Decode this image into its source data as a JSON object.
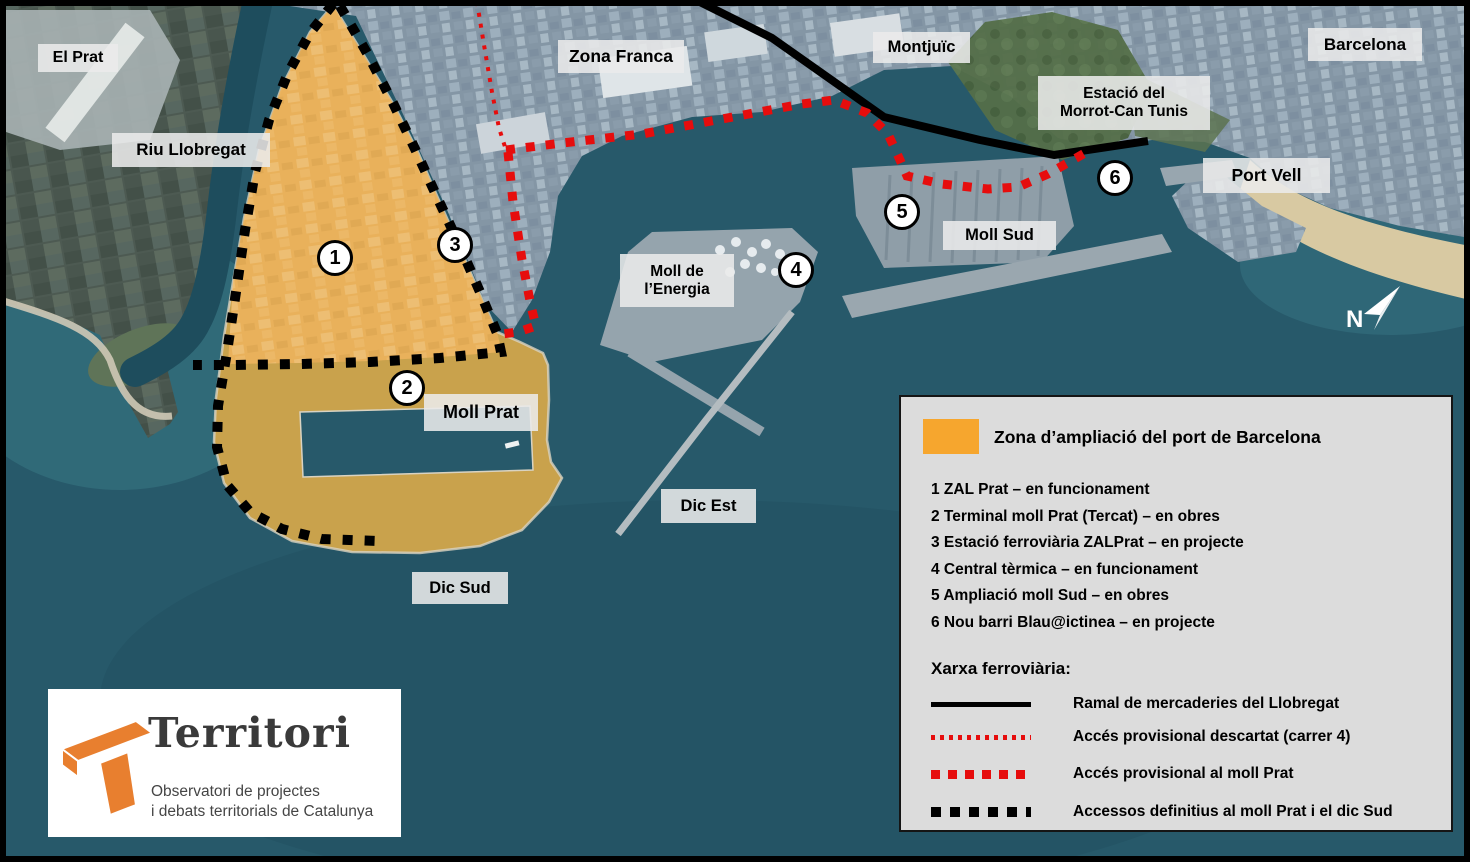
{
  "map": {
    "north_label": "N",
    "labels": [
      {
        "id": "el-prat",
        "text": "El Prat"
      },
      {
        "id": "riu-llobregat",
        "text": "Riu Llobregat"
      },
      {
        "id": "zona-franca",
        "text": "Zona Franca"
      },
      {
        "id": "montjuic",
        "text": "Montjuïc"
      },
      {
        "id": "barcelona",
        "text": "Barcelona"
      },
      {
        "id": "estacio-morrot",
        "line1": "Estació del",
        "line2": "Morrot-Can Tunis"
      },
      {
        "id": "port-vell",
        "text": "Port Vell"
      },
      {
        "id": "moll-sud",
        "text": "Moll Sud"
      },
      {
        "id": "moll-energia",
        "line1": "Moll de",
        "line2": "l’Energia"
      },
      {
        "id": "moll-prat",
        "text": "Moll Prat"
      },
      {
        "id": "dic-est",
        "text": "Dic Est"
      },
      {
        "id": "dic-sud",
        "text": "Dic Sud"
      }
    ],
    "markers": [
      {
        "number": "1"
      },
      {
        "number": "2"
      },
      {
        "number": "3"
      },
      {
        "number": "4"
      },
      {
        "number": "5"
      },
      {
        "number": "6"
      }
    ]
  },
  "legend": {
    "title": "Zona d’ampliació del port de Barcelona",
    "swatch_color": "#f6a62e",
    "items": [
      "1 ZAL Prat – en funcionament",
      "2 Terminal moll Prat (Tercat) – en obres",
      "3 Estació ferroviària ZALPrat – en projecte",
      "4 Central tèrmica – en funcionament",
      "5 Ampliació moll Sud – en obres",
      "6 Nou barri Blau@ictinea – en projecte"
    ],
    "network_title": "Xarxa ferroviària:",
    "network_lines": [
      {
        "style": "solid-black",
        "color": "#000000",
        "label": "Ramal de mercaderies del Llobregat"
      },
      {
        "style": "dotted-red",
        "color": "#e60d0d",
        "label": "Accés provisional descartat (carrer 4)"
      },
      {
        "style": "dashed-red",
        "color": "#e60d0d",
        "label": "Accés provisional al moll Prat"
      },
      {
        "style": "dashed-black",
        "color": "#000000",
        "label": "Accessos definitius al moll Prat i el dic Sud"
      }
    ]
  },
  "logo": {
    "title": "Territori",
    "subtitle_line1": "Observatori de projectes",
    "subtitle_line2": "i debats territorials de Catalunya",
    "accent_color": "#e87f2f"
  },
  "colors": {
    "water": "#27596a",
    "expansion_zone_existing": "#eab25c",
    "expansion_zone_new": "#c9a24c",
    "rail_red": "#e60d0d",
    "rail_black": "#000000",
    "label_bg": "#ececec",
    "legend_bg": "#dcdcdc"
  }
}
